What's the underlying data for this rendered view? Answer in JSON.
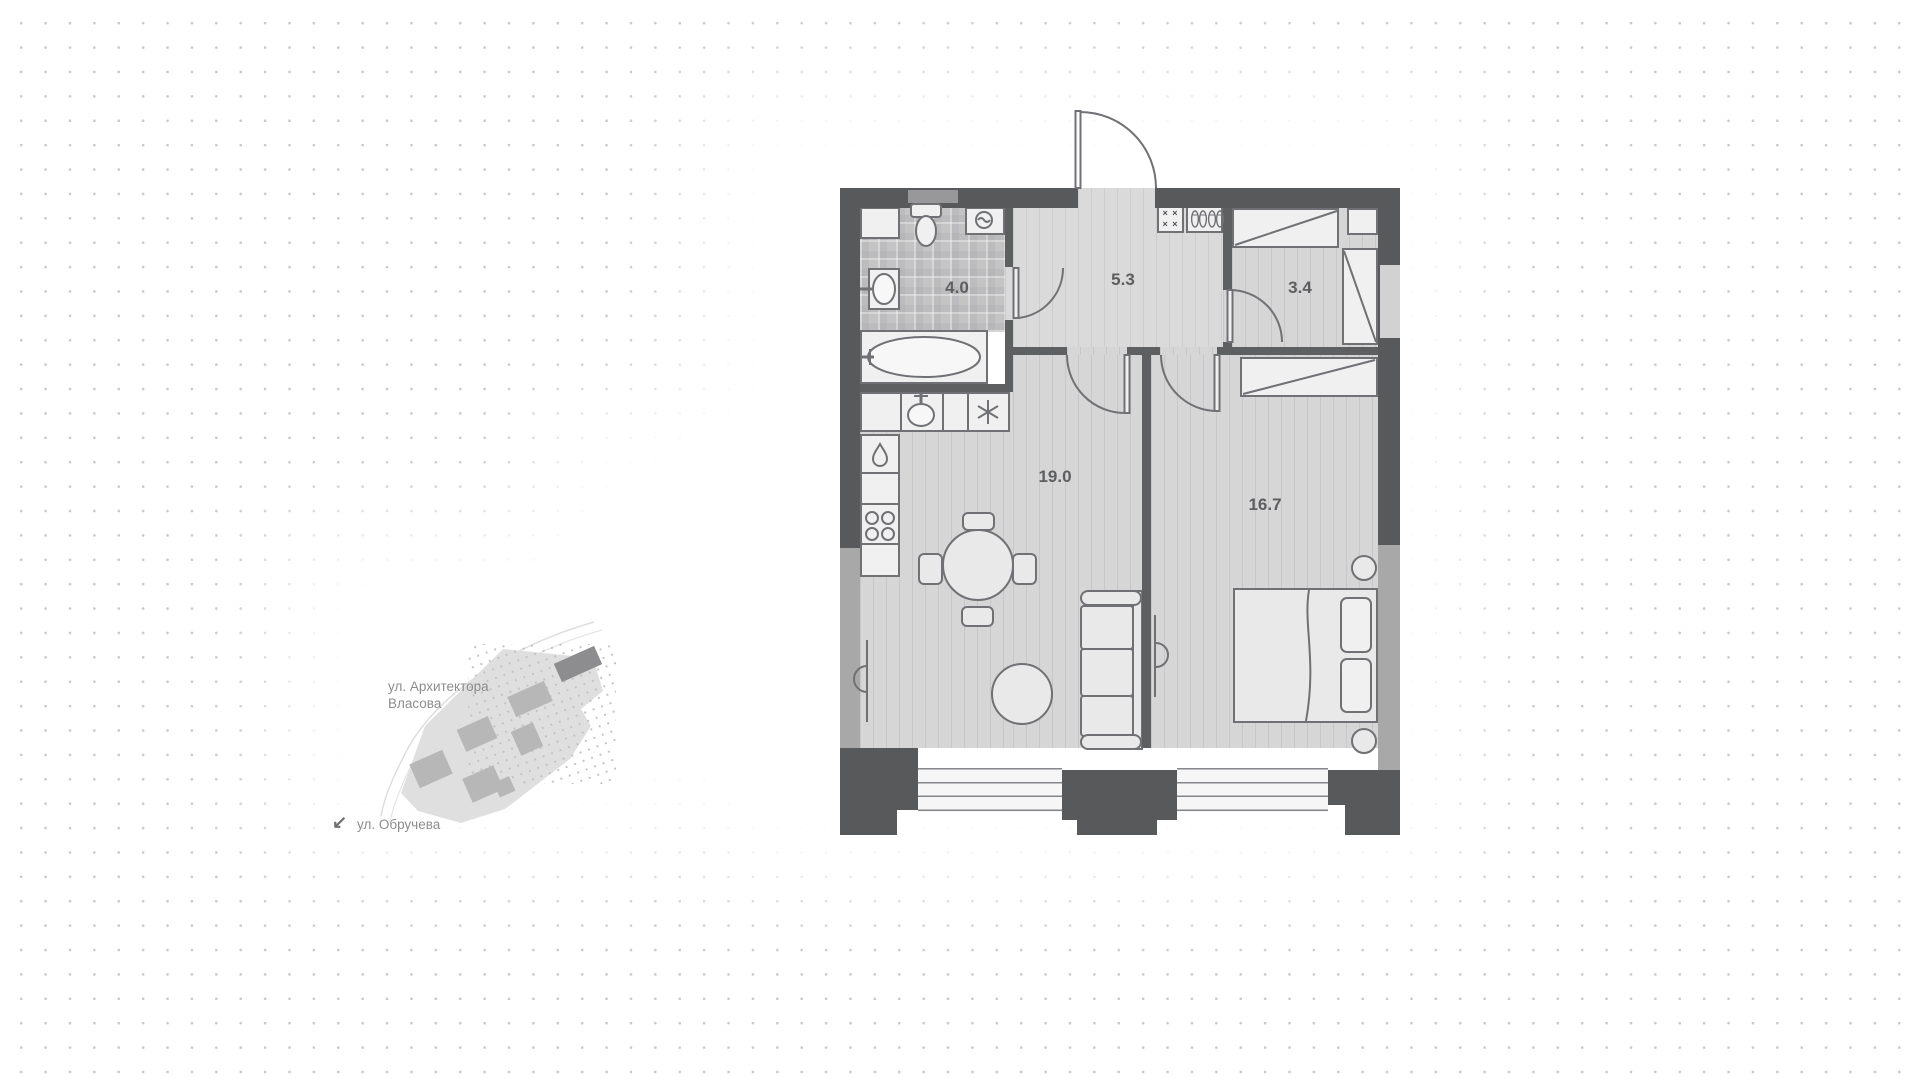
{
  "floor_plan": {
    "rooms": {
      "bathroom": {
        "name": "bathroom",
        "area": "4.0"
      },
      "hallway": {
        "name": "hallway",
        "area": "5.3"
      },
      "closet": {
        "name": "walk-in-closet",
        "area": "3.4"
      },
      "living_room": {
        "name": "living-room-kitchen",
        "area": "19.0"
      },
      "bedroom": {
        "name": "bedroom",
        "area": "16.7"
      }
    }
  },
  "minimap": {
    "street_1_line_1": "ул. Архитектора",
    "street_1_line_2": "Власова",
    "street_2": "ул. Обручева"
  },
  "icons": {
    "hooks_glyph": "× ×\n× ×",
    "map_arrow_glyph": "↙"
  },
  "colors": {
    "wall_dark": "#58595b",
    "wall_medium": "#a8a8a9",
    "partition": "#5e5f61",
    "floor": "#d6d6d7",
    "floor_hall": "#dadadb",
    "bath_tile": "#c4c4c5",
    "fixture_fill": "#f0f0f1",
    "label_text": "#5d5e60",
    "map_text": "#8c8c8e",
    "background_dot": "#c9c9ca"
  }
}
